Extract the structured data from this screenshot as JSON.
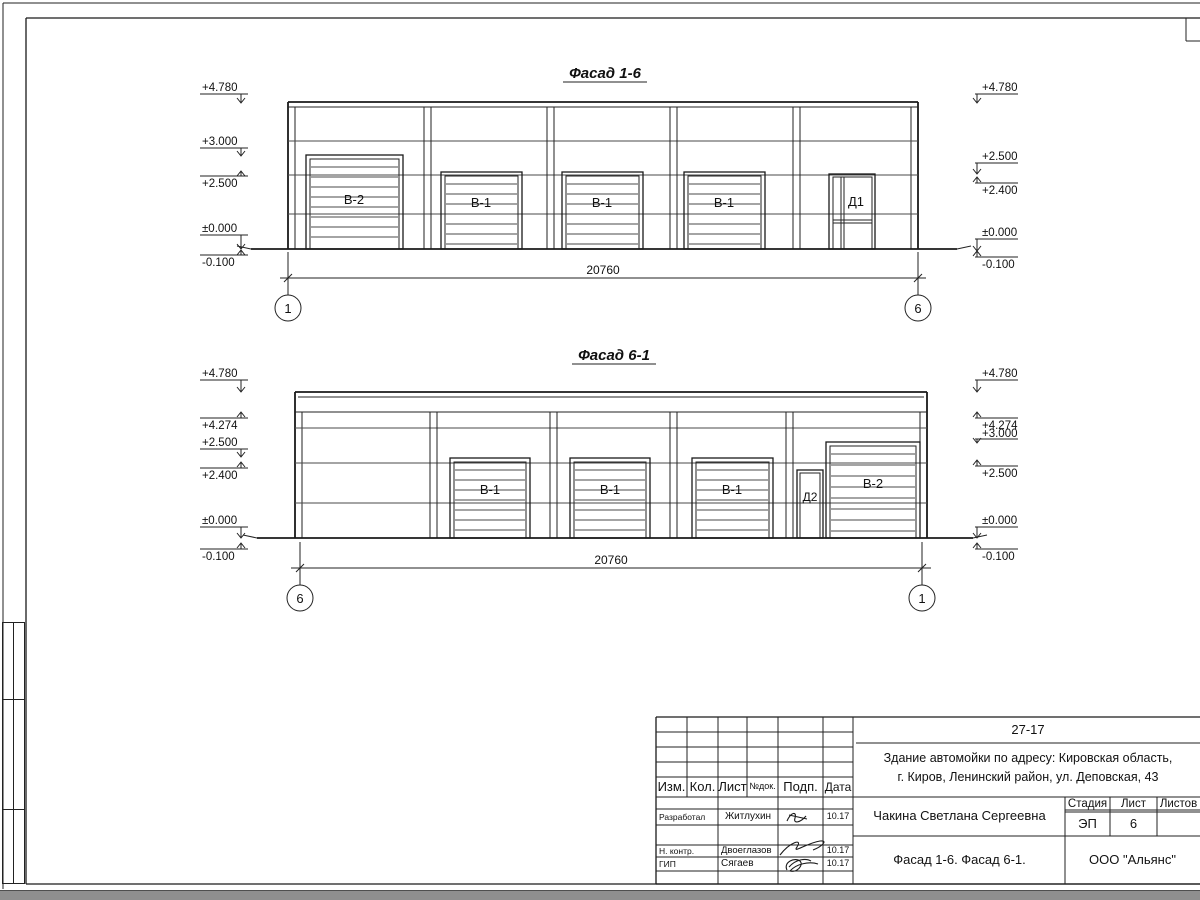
{
  "facade_top": {
    "title": "Фасад 1-6",
    "dimension": "20760",
    "axis_left": "1",
    "axis_right": "6",
    "doors": {
      "b2": "В-2",
      "b1a": "В-1",
      "b1b": "В-1",
      "b1c": "В-1",
      "d": "Д1"
    },
    "marks_left": [
      "+4.780",
      "+3.000",
      "+2.500",
      "±0.000",
      "-0.100"
    ],
    "marks_right": [
      "+4.780",
      "+2.500",
      "+2.400",
      "±0.000",
      "-0.100"
    ]
  },
  "facade_bottom": {
    "title": "Фасад 6-1",
    "dimension": "20760",
    "axis_left": "6",
    "axis_right": "1",
    "doors": {
      "b1a": "В-1",
      "b1b": "В-1",
      "b1c": "В-1",
      "d": "Д2",
      "b2": "В-2"
    },
    "marks_left": [
      "+4.780",
      "+4.274",
      "+2.500",
      "+2.400",
      "±0.000",
      "-0.100"
    ],
    "marks_right": [
      "+4.780",
      "+4.274",
      "+3.000",
      "+2.500",
      "±0.000",
      "-0.100"
    ]
  },
  "side_column": {
    "cells": [
      "Взам. инв. №",
      "Подп. и дата",
      "Инв. № подл."
    ]
  },
  "title_block": {
    "doc_number": "27-17",
    "project_line1": "Здание автомойки по адресу: Кировская область,",
    "project_line2": "г. Киров, Ленинский район, ул. Деповская, 43",
    "col_izm": "Изм.",
    "col_kol": "Кол.",
    "col_list": "Лист",
    "col_ndok": "№док.",
    "col_podp": "Подп.",
    "col_data": "Дата",
    "rows": [
      {
        "role": "Разработал",
        "name": "Житлухин",
        "date": "10.17"
      },
      {
        "role": "Н. контр.",
        "name": "Двоеглазов",
        "date": "10.17"
      },
      {
        "role": "ГИП",
        "name": "Сягаев",
        "date": "10.17"
      }
    ],
    "client": "Чакина Светлана Сергеевна",
    "stage_label": "Стадия",
    "sheet_label": "Лист",
    "sheets_label": "Листов",
    "stage": "ЭП",
    "sheet_number": "6",
    "sheets_total": "",
    "sheet_title": "Фасад 1-6. Фасад 6-1.",
    "organization": "ООО \"Альянс\""
  }
}
